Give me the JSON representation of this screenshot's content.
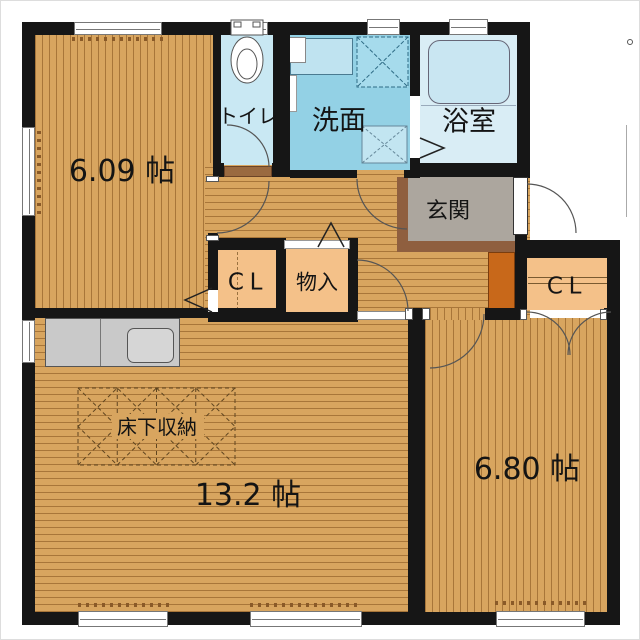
{
  "rooms": {
    "bedroom1": {
      "label": "6.09 帖"
    },
    "toilet": {
      "label": "トイレ"
    },
    "washroom": {
      "label": "洗面"
    },
    "bathroom": {
      "label": "浴室"
    },
    "entrance": {
      "label": "玄関"
    },
    "closet1": {
      "label": "CL"
    },
    "storage": {
      "label": "物入"
    },
    "closet2": {
      "label": "CL"
    },
    "ldk": {
      "label": "13.2 帖"
    },
    "bedroom2": {
      "label": "6.80 帖"
    },
    "underfloor": {
      "label": "床下収納"
    }
  },
  "colors": {
    "wood": "#d8a55f",
    "closet_wood": "#f4c189",
    "toilet_floor": "#c9e8f3",
    "washroom_floor": "#93d1e5",
    "bathroom_floor": "#d9edf5",
    "entrance_floor": "#aca69e",
    "entrance_step": "#8f5f3f",
    "shoe_cabinet": "#c8681a",
    "kitchen_counter": "#c9c9c9",
    "wall": "#161616"
  }
}
